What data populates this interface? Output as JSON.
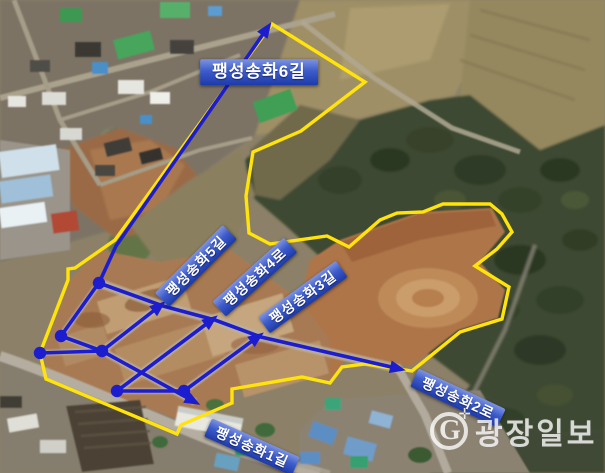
{
  "road_labels": {
    "songhwa6": "팽성송화6길",
    "songhwa5": "팽성송화5길",
    "songhwa4": "팽성송화4로",
    "songhwa3": "팽성송화3길",
    "songhwa2": "팽성송화2로",
    "songhwa1": "팽성송화1길"
  },
  "watermark": {
    "logo_letter": "G",
    "spark": "✛",
    "text": "광장일보"
  },
  "colors": {
    "boundary": "#ffe30a",
    "road": "#1d1dd0",
    "label_blue_top": "#7d93e2",
    "label_blue_bottom": "#1d3aa8"
  },
  "overlay": {
    "boundary": [
      [
        272,
        24
      ],
      [
        365,
        82
      ],
      [
        301,
        131
      ],
      [
        253,
        152
      ],
      [
        246,
        196
      ],
      [
        249,
        233
      ],
      [
        270,
        244
      ],
      [
        327,
        236
      ],
      [
        349,
        247
      ],
      [
        380,
        220
      ],
      [
        397,
        213
      ],
      [
        423,
        212
      ],
      [
        443,
        204
      ],
      [
        490,
        204
      ],
      [
        502,
        214
      ],
      [
        512,
        232
      ],
      [
        497,
        249
      ],
      [
        475,
        266
      ],
      [
        509,
        287
      ],
      [
        502,
        319
      ],
      [
        460,
        332
      ],
      [
        412,
        371
      ],
      [
        365,
        364
      ],
      [
        342,
        367
      ],
      [
        330,
        383
      ],
      [
        302,
        377
      ],
      [
        232,
        389
      ],
      [
        232,
        403
      ],
      [
        181,
        425
      ],
      [
        177,
        434
      ],
      [
        46,
        379
      ],
      [
        40,
        353
      ],
      [
        68,
        280
      ],
      [
        68,
        269
      ],
      [
        75,
        268
      ],
      [
        115,
        240
      ]
    ],
    "roads": [
      {
        "name": "songhwa6-road-arrow",
        "points": [
          [
            99,
            283
          ],
          [
            116,
            246
          ],
          [
            268,
            27
          ]
        ],
        "arrow": true
      },
      {
        "name": "main-exit-road-arrow",
        "points": [
          [
            99,
            283
          ],
          [
            163,
            306
          ],
          [
            215,
            320
          ],
          [
            261,
            337
          ],
          [
            400,
            369
          ]
        ],
        "arrow": true
      },
      {
        "name": "songhwa5-road-arrow",
        "points": [
          [
            102,
            351
          ],
          [
            161,
            305
          ]
        ],
        "arrow": true
      },
      {
        "name": "songhwa4-road-arrow",
        "points": [
          [
            117,
            391
          ],
          [
            213,
            319
          ]
        ],
        "arrow": true
      },
      {
        "name": "songhwa3-road-arrow",
        "points": [
          [
            184,
            391
          ],
          [
            259,
            336
          ]
        ],
        "arrow": true
      },
      {
        "name": "songhwa1-road-arrow",
        "points": [
          [
            102,
            351
          ],
          [
            195,
            402
          ]
        ],
        "arrow": true
      },
      {
        "name": "west-edge-road",
        "points": [
          [
            98,
            284
          ],
          [
            61,
            336
          ]
        ],
        "arrow": false
      },
      {
        "name": "connector-road-bd",
        "points": [
          [
            61,
            336
          ],
          [
            102,
            351
          ]
        ],
        "arrow": false
      },
      {
        "name": "connector-road-cd",
        "points": [
          [
            40,
            353
          ],
          [
            102,
            351
          ]
        ],
        "arrow": false
      },
      {
        "name": "connector-road-ef",
        "points": [
          [
            117,
            391
          ],
          [
            184,
            391
          ]
        ],
        "arrow": false
      }
    ],
    "nodes": [
      [
        99,
        283
      ],
      [
        61,
        336
      ],
      [
        40,
        353
      ],
      [
        102,
        351
      ],
      [
        117,
        391
      ],
      [
        184,
        391
      ]
    ]
  }
}
